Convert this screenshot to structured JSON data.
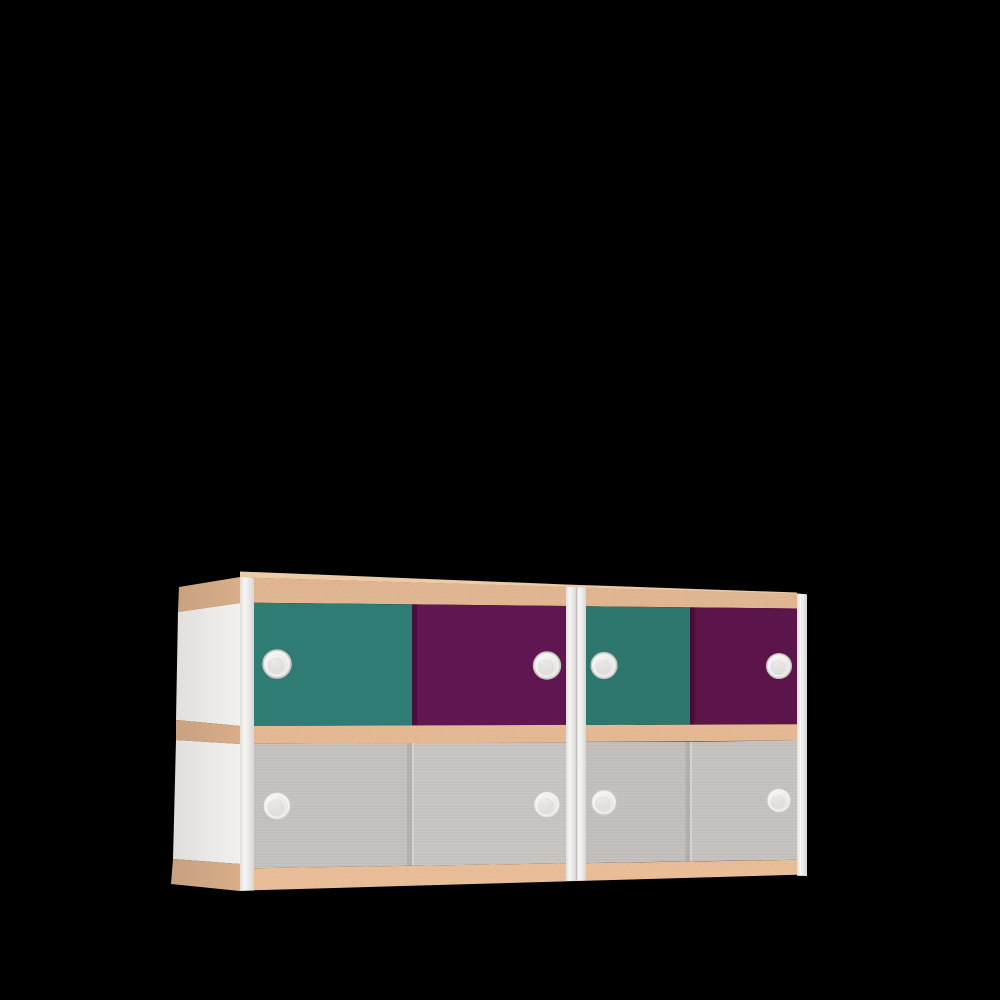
{
  "scene": {
    "description": "3D product render of two side-by-side sliding-door cabinet modules with wood rails, white posts and round recessed handles, on a black background",
    "background_color": "#000000",
    "modules": [
      {
        "id": "module-1",
        "top_row_doors": [
          {
            "position": "left",
            "color_name": "teal",
            "handle": "round recessed pull"
          },
          {
            "position": "right",
            "color_name": "purple",
            "handle": "round recessed pull"
          }
        ],
        "bottom_row_doors": [
          {
            "position": "left",
            "color_name": "gray",
            "handle": "round recessed pull"
          },
          {
            "position": "right",
            "color_name": "gray",
            "handle": "round recessed pull"
          }
        ]
      },
      {
        "id": "module-2",
        "top_row_doors": [
          {
            "position": "left",
            "color_name": "teal",
            "handle": "round recessed pull"
          },
          {
            "position": "right",
            "color_name": "purple",
            "handle": "round recessed pull"
          }
        ],
        "bottom_row_doors": [
          {
            "position": "left",
            "color_name": "gray",
            "handle": "round recessed pull"
          },
          {
            "position": "right",
            "color_name": "gray",
            "handle": "round recessed pull"
          }
        ]
      }
    ],
    "handle_count": 8,
    "frame": {
      "rail_material": "wood",
      "post_material": "white-laminate",
      "side_panel_material": "white-laminate"
    },
    "colors": {
      "background": "#000000",
      "wood_rail_top": "#e0b592",
      "wood_top_surface": "#edcba7",
      "wood_rail_mid": "#e3b893",
      "wood_rail_bottom": "#e8bd97",
      "wood_side_rail": "#d9ae89",
      "side_panel": "#f3f1ef",
      "teal_m1": "#2f7c74",
      "teal_m2": "#2d776f",
      "purple_m1": "#601650",
      "purple_m2": "#5c154b",
      "gray_m1_left": "#c4c1be",
      "gray_m1_right": "#c7c4c1",
      "gray_m2_left": "#c2bfbc",
      "gray_m2_right": "#c5c2bf",
      "post_stop_1": "#dfddda",
      "post_stop_2": "#f6f5f3",
      "post_stop_3": "#efedeb",
      "post_stop_4": "#d8d6d4",
      "handle_hi": "#f8f7f5",
      "handle_mid": "#ebe9e7",
      "handle_lo": "#d9d6d3",
      "handle_ring": "#c6c3c0"
    }
  }
}
